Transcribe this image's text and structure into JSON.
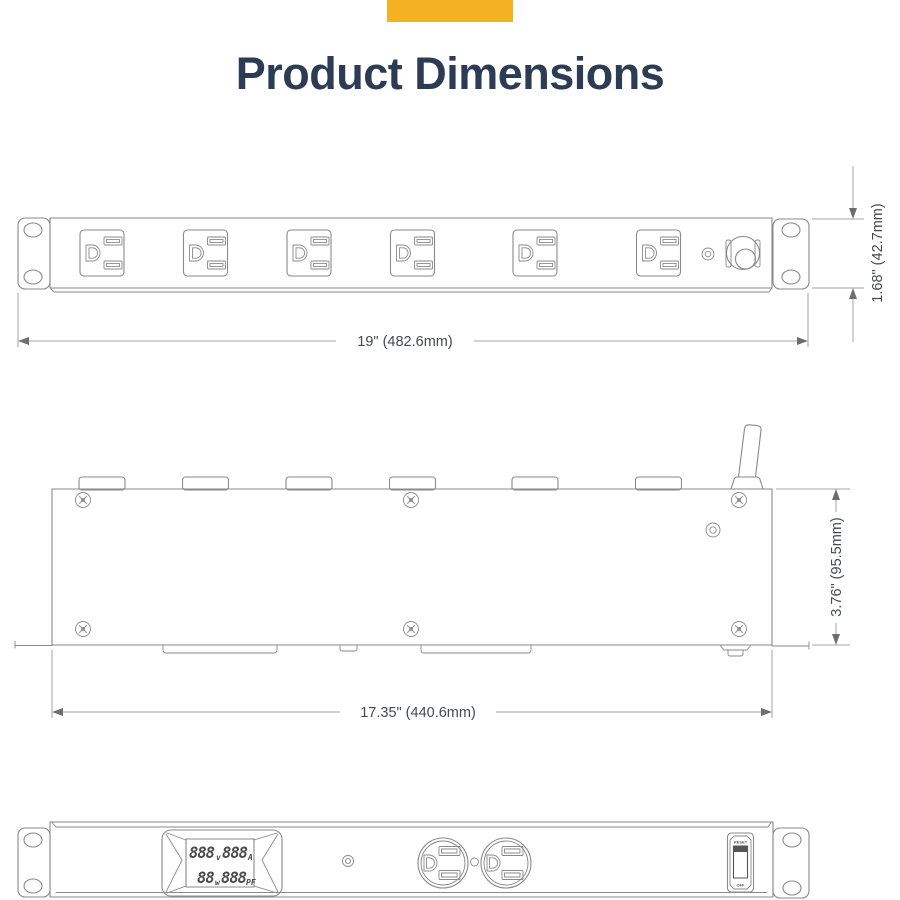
{
  "header": {
    "title": "Product Dimensions",
    "accent_bar_color": "#F4B223",
    "title_color": "#2D3C54"
  },
  "drawing": {
    "line_color": "#8A8A8A",
    "front_view": {
      "outlet_count": 6,
      "width_dim": "19\" (482.6mm)",
      "height_dim": "1.68\" (42.7mm)"
    },
    "top_view": {
      "width_dim": "17.35\" (440.6mm)",
      "height_dim": "3.76\" (95.5mm)"
    },
    "meter_view": {
      "lcd": {
        "volts_value": "888",
        "volts_unit": "v",
        "amps_value": "888",
        "amps_unit": "A",
        "watts_value": "88",
        "watts_unit": "w",
        "pf_value": "888",
        "pf_unit": "PF"
      },
      "switch_top_label": "RESET",
      "switch_bottom_label": "OFF"
    }
  }
}
